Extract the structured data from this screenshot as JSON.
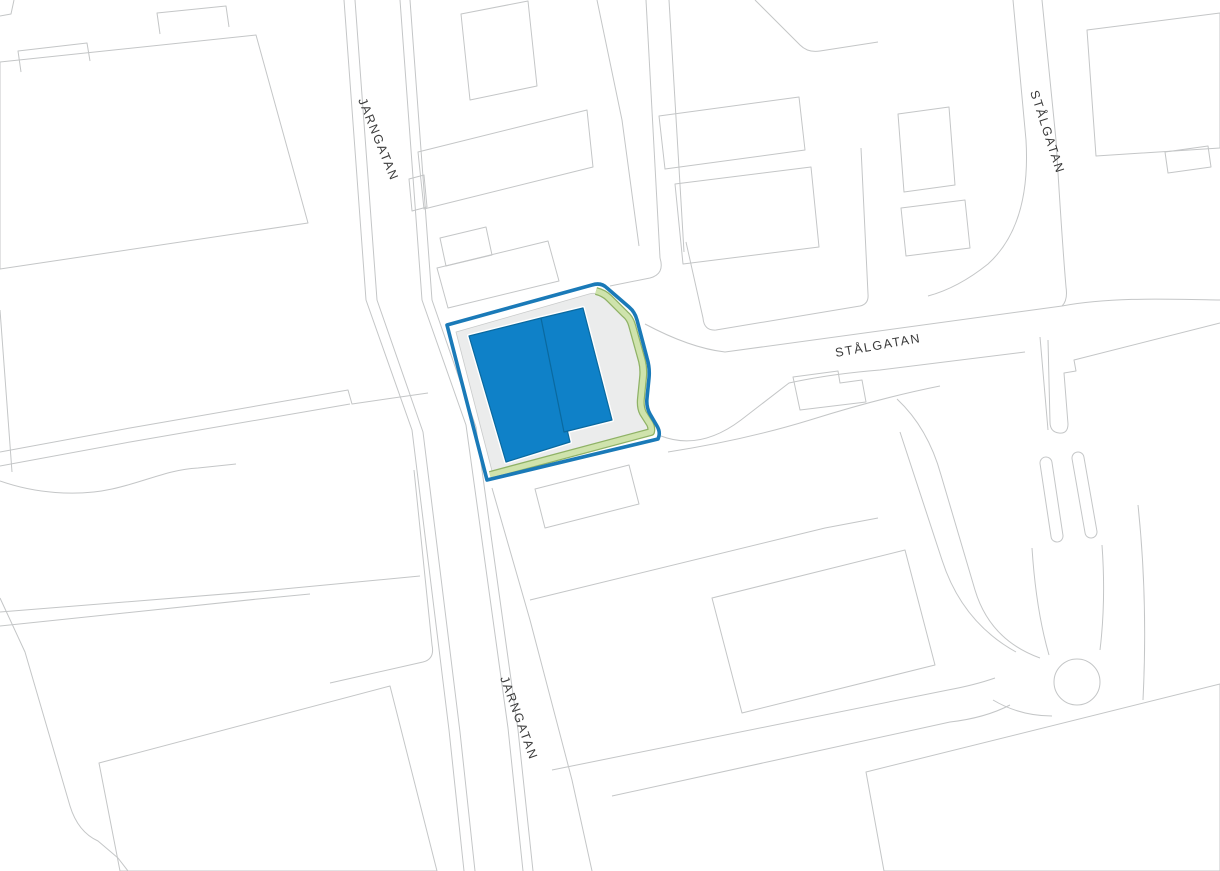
{
  "map": {
    "title": "site-plan",
    "background": "#ffffff",
    "colors": {
      "basemap_line": "#c4c6c7",
      "label_text": "#3b3b3b",
      "parcel_yard_fill": "#ebecec",
      "parcel_border_blue": "#1a7ab8",
      "green_buffer_fill": "#cfe3ac",
      "green_buffer_line": "#8fb266",
      "building_fill_blue": "#0f81c8",
      "building_line_blue": "#0a699f"
    },
    "labels": [
      {
        "kind": "text",
        "name": "street-label-jarngatan-north",
        "text": "JARNGATAN",
        "x": 358,
        "y": 100,
        "rot": 68,
        "size": 12.5,
        "ls": 1.6
      },
      {
        "kind": "text",
        "name": "street-label-jarngatan-south",
        "text": "JARNGATAN",
        "x": 500,
        "y": 678,
        "rot": 70,
        "size": 12.5,
        "ls": 1.6
      },
      {
        "kind": "text",
        "name": "street-label-stalgatan-center",
        "text": "STÅLGATAN",
        "x": 836,
        "y": 357,
        "rot": -10,
        "size": 12.5,
        "ls": 1.6
      },
      {
        "kind": "text",
        "name": "street-label-stalgatan-east",
        "text": "STÅLGATAN",
        "x": 1030,
        "y": 92,
        "rot": 72,
        "size": 12.5,
        "ls": 1.6
      }
    ],
    "shapes": [
      {
        "kind": "path",
        "name": "corner-strip-line",
        "d": "M0,16 L11,14 L14,0",
        "stroke": "#c4c6c7",
        "w": 1
      },
      {
        "kind": "path",
        "name": "building-outline-large-west",
        "d": "M0,62 L256,35 L308,223 L0,269 Z",
        "stroke": "#c4c6c7",
        "w": 1
      },
      {
        "kind": "path",
        "name": "building-annex-west-1",
        "d": "M21,72 L18,51 L87,43 L90,61",
        "stroke": "#c4c6c7",
        "w": 1
      },
      {
        "kind": "path",
        "name": "building-annex-west-2",
        "d": "M160,34 L157,13 L226,6 L229,27",
        "stroke": "#c4c6c7",
        "w": 1
      },
      {
        "kind": "path",
        "name": "parcel-line-west-edge",
        "d": "M0,310 L12,472",
        "stroke": "#c4c6c7",
        "w": 1
      },
      {
        "kind": "path",
        "name": "stream-boundary-line",
        "d": "M0,481 C34,493 76,497 112,489 C148,481 166,470 198,468 L236,464",
        "stroke": "#c4c6c7",
        "w": 1
      },
      {
        "kind": "path",
        "name": "parcel-boundary-west-a",
        "d": "M0,452 L130,428 L348,390 L352,404 L428,393",
        "stroke": "#c4c6c7",
        "w": 1
      },
      {
        "kind": "path",
        "name": "parcel-boundary-west-b",
        "d": "M0,466 L130,442 L350,404",
        "stroke": "#c4c6c7",
        "w": 1
      },
      {
        "kind": "path",
        "name": "parcel-boundary-southwest-a",
        "d": "M0,612 L262,591 L420,576",
        "stroke": "#c4c6c7",
        "w": 1
      },
      {
        "kind": "path",
        "name": "parcel-boundary-southwest-b",
        "d": "M0,626 L258,599 L310,594",
        "stroke": "#c4c6c7",
        "w": 1
      },
      {
        "kind": "path",
        "name": "parcel-boundary-southwest-c",
        "d": "M0,598 L25,652 L70,806 Q78,832 98,841 L118,858 L128,871",
        "stroke": "#c4c6c7",
        "w": 1
      },
      {
        "kind": "path",
        "name": "building-outline-southwest",
        "d": "M99,763 L390,686 L437,871 L120,871 Z",
        "stroke": "#c4c6c7",
        "w": 1
      },
      {
        "kind": "path",
        "name": "street-line-jarngatan-west-outer",
        "d": "M344,0 L366,300 L412,430 L449,730 L464,871",
        "stroke": "#c4c6c7",
        "w": 1
      },
      {
        "kind": "path",
        "name": "street-line-jarngatan-west-inner",
        "d": "M355,0 L377,300 L423,432 L460,732 L475,871",
        "stroke": "#c4c6c7",
        "w": 1
      },
      {
        "kind": "path",
        "name": "street-line-jarngatan-east-inner",
        "d": "M400,0 L422,300 L466,425 L508,728 L523,871",
        "stroke": "#c4c6c7",
        "w": 1
      },
      {
        "kind": "path",
        "name": "street-line-jarngatan-east-outer",
        "d": "M410,0 L432,300 L476,427 L518,730 L533,871",
        "stroke": "#c4c6c7",
        "w": 1
      },
      {
        "kind": "path",
        "name": "parcel-corner-west-of-street",
        "d": "M414,470 L432,645 Q435,659 423,662 L330,683",
        "stroke": "#c4c6c7",
        "w": 1
      },
      {
        "kind": "path",
        "name": "parcel-boundary-east-of-street",
        "d": "M492,488 L530,620 L572,780 L592,871",
        "stroke": "#c4c6c7",
        "w": 1
      },
      {
        "kind": "path",
        "name": "building-outline-north-of-parcel",
        "d": "M437,268 L548,241 L559,281 L448,308 Z",
        "stroke": "#c4c6c7",
        "w": 1
      },
      {
        "kind": "path",
        "name": "building-outline-small-north",
        "d": "M440,238 L486,227 L492,255 L446,266 Z",
        "stroke": "#c4c6c7",
        "w": 1
      },
      {
        "kind": "path",
        "name": "building-outline-top-center-1",
        "d": "M461,14 L528,1 L537,86 L470,100 Z",
        "stroke": "#c4c6c7",
        "w": 1
      },
      {
        "kind": "path",
        "name": "building-outline-top-center-2",
        "d": "M418,152 L587,110 L593,167 L424,209 Z",
        "stroke": "#c4c6c7",
        "w": 1
      },
      {
        "kind": "path",
        "name": "building-annex-top-center",
        "d": "M409,179 L424,175 L427,207 L412,211 Z",
        "stroke": "#c4c6c7",
        "w": 1
      },
      {
        "kind": "path",
        "name": "lane-line-center-a",
        "d": "M646,0 L660,258",
        "stroke": "#c4c6c7",
        "w": 1
      },
      {
        "kind": "path",
        "name": "lane-line-center-b",
        "d": "M669,0 L684,252",
        "stroke": "#c4c6c7",
        "w": 1
      },
      {
        "kind": "path",
        "name": "parcel-boundary-top-center",
        "d": "M597,0 L622,120 L639,246",
        "stroke": "#c4c6c7",
        "w": 1
      },
      {
        "kind": "path",
        "name": "road-edge-curve-center",
        "d": "M660,258 Q665,274 650,278 L610,286",
        "stroke": "#c4c6c7",
        "w": 1
      },
      {
        "kind": "path",
        "name": "parcel-boundary-north-block",
        "d": "M686,242 L703,318 Q704,331 716,330 L860,306 Q869,304 868,294 L861,148",
        "stroke": "#c4c6c7",
        "w": 1
      },
      {
        "kind": "path",
        "name": "building-outline-north-block-1",
        "d": "M659,116 L799,97 L805,150 L665,169 Z",
        "stroke": "#c4c6c7",
        "w": 1
      },
      {
        "kind": "path",
        "name": "building-outline-north-block-2",
        "d": "M675,184 L811,167 L819,247 L683,264 Z",
        "stroke": "#c4c6c7",
        "w": 1
      },
      {
        "kind": "path",
        "name": "building-outline-ne-1",
        "d": "M898,114 L949,107 L955,185 L904,192 Z",
        "stroke": "#c4c6c7",
        "w": 1
      },
      {
        "kind": "path",
        "name": "building-outline-ne-2",
        "d": "M901,208 L965,200 L970,248 L906,256 Z",
        "stroke": "#c4c6c7",
        "w": 1
      },
      {
        "kind": "path",
        "name": "boundary-diagonal-top",
        "d": "M755,0 L800,45 Q808,53 820,51 L878,42",
        "stroke": "#c4c6c7",
        "w": 1
      },
      {
        "kind": "path",
        "name": "stalgatan-east-street-west-edge",
        "d": "M1013,0 L1026,140 Q1031,225 988,264 Q958,288 928,296",
        "stroke": "#c4c6c7",
        "w": 1
      },
      {
        "kind": "path",
        "name": "stalgatan-east-street-east-edge",
        "d": "M1042,0 L1056,140 Q1062,240 1066,287 Q1068,300 1062,306",
        "stroke": "#c4c6c7",
        "w": 1
      },
      {
        "kind": "path",
        "name": "building-outline-top-right",
        "d": "M1087,30 L1220,13 L1220,148 L1096,156 Z",
        "stroke": "#c4c6c7",
        "w": 1
      },
      {
        "kind": "path",
        "name": "building-annex-top-right",
        "d": "M1165,152 L1208,146 L1211,167 L1168,173 Z",
        "stroke": "#c4c6c7",
        "w": 1
      },
      {
        "kind": "path",
        "name": "stalgatan-north-edge",
        "d": "M645,324 Q690,348 725,352 L1018,312 Q1040,309 1062,306",
        "stroke": "#c4c6c7",
        "w": 1
      },
      {
        "kind": "path",
        "name": "stalgatan-south-edge",
        "d": "M661,436 Q700,451 741,420 L789,383 Q830,374 880,370 L1025,352",
        "stroke": "#c4c6c7",
        "w": 1
      },
      {
        "kind": "path",
        "name": "building-outline-south-of-stalgatan",
        "d": "M793,377 L838,371 L840,383 L862,380 L866,402 L800,410 Z",
        "stroke": "#c4c6c7",
        "w": 1
      },
      {
        "kind": "path",
        "name": "parcel-boundary-east-center",
        "d": "M668,452 Q745,440 810,420 Q880,398 940,386",
        "stroke": "#c4c6c7",
        "w": 1
      },
      {
        "kind": "path",
        "name": "road-edge-branch-southeast",
        "d": "M897,399 Q928,428 941,475 L975,590 Q990,640 1040,658",
        "stroke": "#c4c6c7",
        "w": 1
      },
      {
        "kind": "path",
        "name": "parcel-line-right-a",
        "d": "M1040,337 L1048,430",
        "stroke": "#c4c6c7",
        "w": 1
      },
      {
        "kind": "path",
        "name": "road-edge-right",
        "d": "M1062,306 C1110,297 1165,299 1220,300",
        "stroke": "#c4c6c7",
        "w": 1
      },
      {
        "kind": "path",
        "name": "parcel-strip-right",
        "d": "M1220,323 L1074,360 L1076,371 L1064,373 L1068,424 Q1068,434 1059,433 Q1050,432 1050,422 L1048,340",
        "stroke": "#c4c6c7",
        "w": 1
      },
      {
        "kind": "path",
        "name": "parcel-boundary-roundabout-west",
        "d": "M900,432 L942,560 Q962,622 1016,652",
        "stroke": "#c4c6c7",
        "w": 1
      },
      {
        "kind": "path",
        "name": "road-line-bottom-right",
        "d": "M1138,505 Q1148,600 1143,700",
        "stroke": "#c4c6c7",
        "w": 1
      },
      {
        "kind": "path",
        "name": "parcel-boundary-south-center",
        "d": "M530,600 L825,528 L878,518",
        "stroke": "#c4c6c7",
        "w": 1
      },
      {
        "kind": "path",
        "name": "building-outline-south-center",
        "d": "M712,598 L905,550 L935,665 L742,713 Z",
        "stroke": "#c4c6c7",
        "w": 1
      },
      {
        "kind": "path",
        "name": "road-edge-lower-a",
        "d": "M552,770 L948,690 Q975,685 995,678",
        "stroke": "#c4c6c7",
        "w": 1
      },
      {
        "kind": "path",
        "name": "road-edge-lower-b",
        "d": "M612,796 L950,722 Q985,718 1010,705",
        "stroke": "#c4c6c7",
        "w": 1
      },
      {
        "kind": "path",
        "name": "building-outline-bottom-right",
        "d": "M866,772 L1220,684 L1220,871 L884,871 Z",
        "stroke": "#c4c6c7",
        "w": 1
      },
      {
        "kind": "path",
        "name": "building-outline-below-parcel",
        "d": "M535,489 L629,465 L639,504 L545,528 Z",
        "stroke": "#c4c6c7",
        "w": 1
      },
      {
        "kind": "path",
        "name": "road-edge-north-approach-west",
        "d": "M1032,548 Q1036,610 1049,655",
        "stroke": "#c4c6c7",
        "w": 1
      },
      {
        "kind": "path",
        "name": "road-edge-north-approach-east",
        "d": "M1102,545 Q1106,600 1100,650",
        "stroke": "#c4c6c7",
        "w": 1
      },
      {
        "kind": "path",
        "name": "road-edge-below-roundabout",
        "d": "M993,700 Q1020,716 1052,716",
        "stroke": "#c4c6c7",
        "w": 1
      },
      {
        "kind": "line",
        "name": "traffic-island-west-outline",
        "x1": 1046,
        "y1": 463,
        "x2": 1057,
        "y2": 536,
        "stroke": "#c4c6c7",
        "w": 13,
        "cap": "round"
      },
      {
        "kind": "line",
        "name": "traffic-island-west",
        "x1": 1046,
        "y1": 463,
        "x2": 1057,
        "y2": 536,
        "stroke": "#ffffff",
        "w": 11,
        "cap": "round"
      },
      {
        "kind": "line",
        "name": "traffic-island-east-outline",
        "x1": 1078,
        "y1": 458,
        "x2": 1091,
        "y2": 532,
        "stroke": "#c4c6c7",
        "w": 13,
        "cap": "round"
      },
      {
        "kind": "line",
        "name": "traffic-island-east",
        "x1": 1078,
        "y1": 458,
        "x2": 1091,
        "y2": 532,
        "stroke": "#ffffff",
        "w": 11,
        "cap": "round"
      },
      {
        "kind": "circle",
        "name": "roundabout",
        "cx": 1077,
        "cy": 682,
        "r": 23,
        "fill": "#ffffff",
        "stroke": "#c4c6c7",
        "w": 1
      },
      {
        "kind": "path",
        "name": "parcel-yard",
        "inter": true,
        "d": "M456,332 L589,294 Q596,292 601,296 L622,314 Q627,318 629,325 L639,361 Q641,369 640,378 L638,398 Q637,407 641,413 L647,423 Q649,427 648,431 L492,471 Z",
        "fill": "#ebecec",
        "stroke": "#c9cbcb",
        "w": 0.8
      },
      {
        "kind": "path",
        "name": "green-buffer-outline",
        "d": "M596,291 Q604,293 609,298 L625,314 Q630,318 632,325 L642,361 Q644,369 643,378 L641,398 Q640,407 643,413 L650,424 Q652,428 651,432 L490,475",
        "stroke": "#8fb266",
        "w": 8
      },
      {
        "kind": "path",
        "name": "green-buffer",
        "d": "M596,291 Q604,293 609,298 L625,314 Q630,318 632,325 L642,361 Q644,369 643,378 L641,398 Q640,407 643,413 L650,424 Q652,428 651,432 L490,475",
        "stroke": "#cfe3ac",
        "w": 5.5
      },
      {
        "kind": "path",
        "name": "highlighted-parcel-boundary",
        "inter": true,
        "d": "M447,325 L592,285 Q601,282 607,288 L629,307 Q635,312 637,320 L647,358 Q650,368 649,378 L647,398 Q646,407 650,414 L657,426 Q660,431 659,436 L658,439 L487,480 Z",
        "stroke": "#1a7ab8",
        "w": 3.6
      },
      {
        "kind": "path",
        "name": "building-a-halo",
        "d": "M469,336 L541,318 L570,442 L506,462 Z",
        "stroke": "#ffffff",
        "w": 4
      },
      {
        "kind": "path",
        "name": "building-b-halo",
        "d": "M541,318 L583,308 L612,420 L564,432 Z",
        "stroke": "#ffffff",
        "w": 4
      },
      {
        "kind": "path",
        "name": "building-a",
        "inter": true,
        "d": "M469,336 L541,318 L570,442 L506,462 Z",
        "fill": "#0f81c8",
        "stroke": "#0a699f",
        "w": 1.2
      },
      {
        "kind": "path",
        "name": "building-b",
        "inter": true,
        "d": "M541,318 L583,308 L612,420 L564,432 Z",
        "fill": "#0f81c8",
        "stroke": "#0a699f",
        "w": 1.2
      }
    ]
  }
}
